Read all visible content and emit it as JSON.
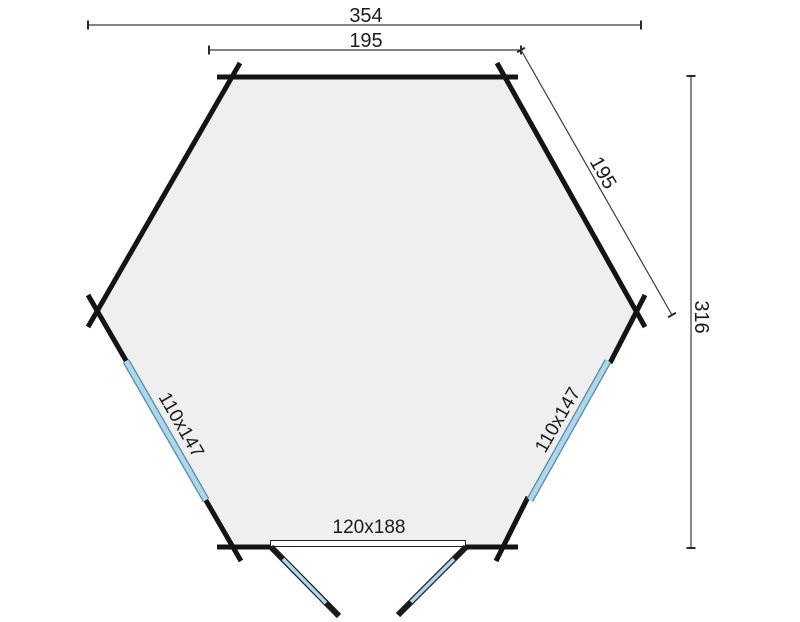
{
  "plan": {
    "type": "hexagonal-cabin-floor-plan",
    "dimensions": {
      "overall_width_label": "354",
      "top_wall_label": "195",
      "upper_right_wall_label": "195",
      "overall_depth_label": "316"
    },
    "openings": {
      "left_window_label": "110x147",
      "right_window_label": "110x147",
      "double_door_label": "120x188"
    },
    "colors": {
      "background": "#ffffff",
      "wall": "#141414",
      "floor": "#efefef",
      "glass": "#aad9ee",
      "glass_outline": "#5d89a4",
      "dimension_line": "#3a3a3a",
      "text": "#1c1c1c"
    }
  }
}
